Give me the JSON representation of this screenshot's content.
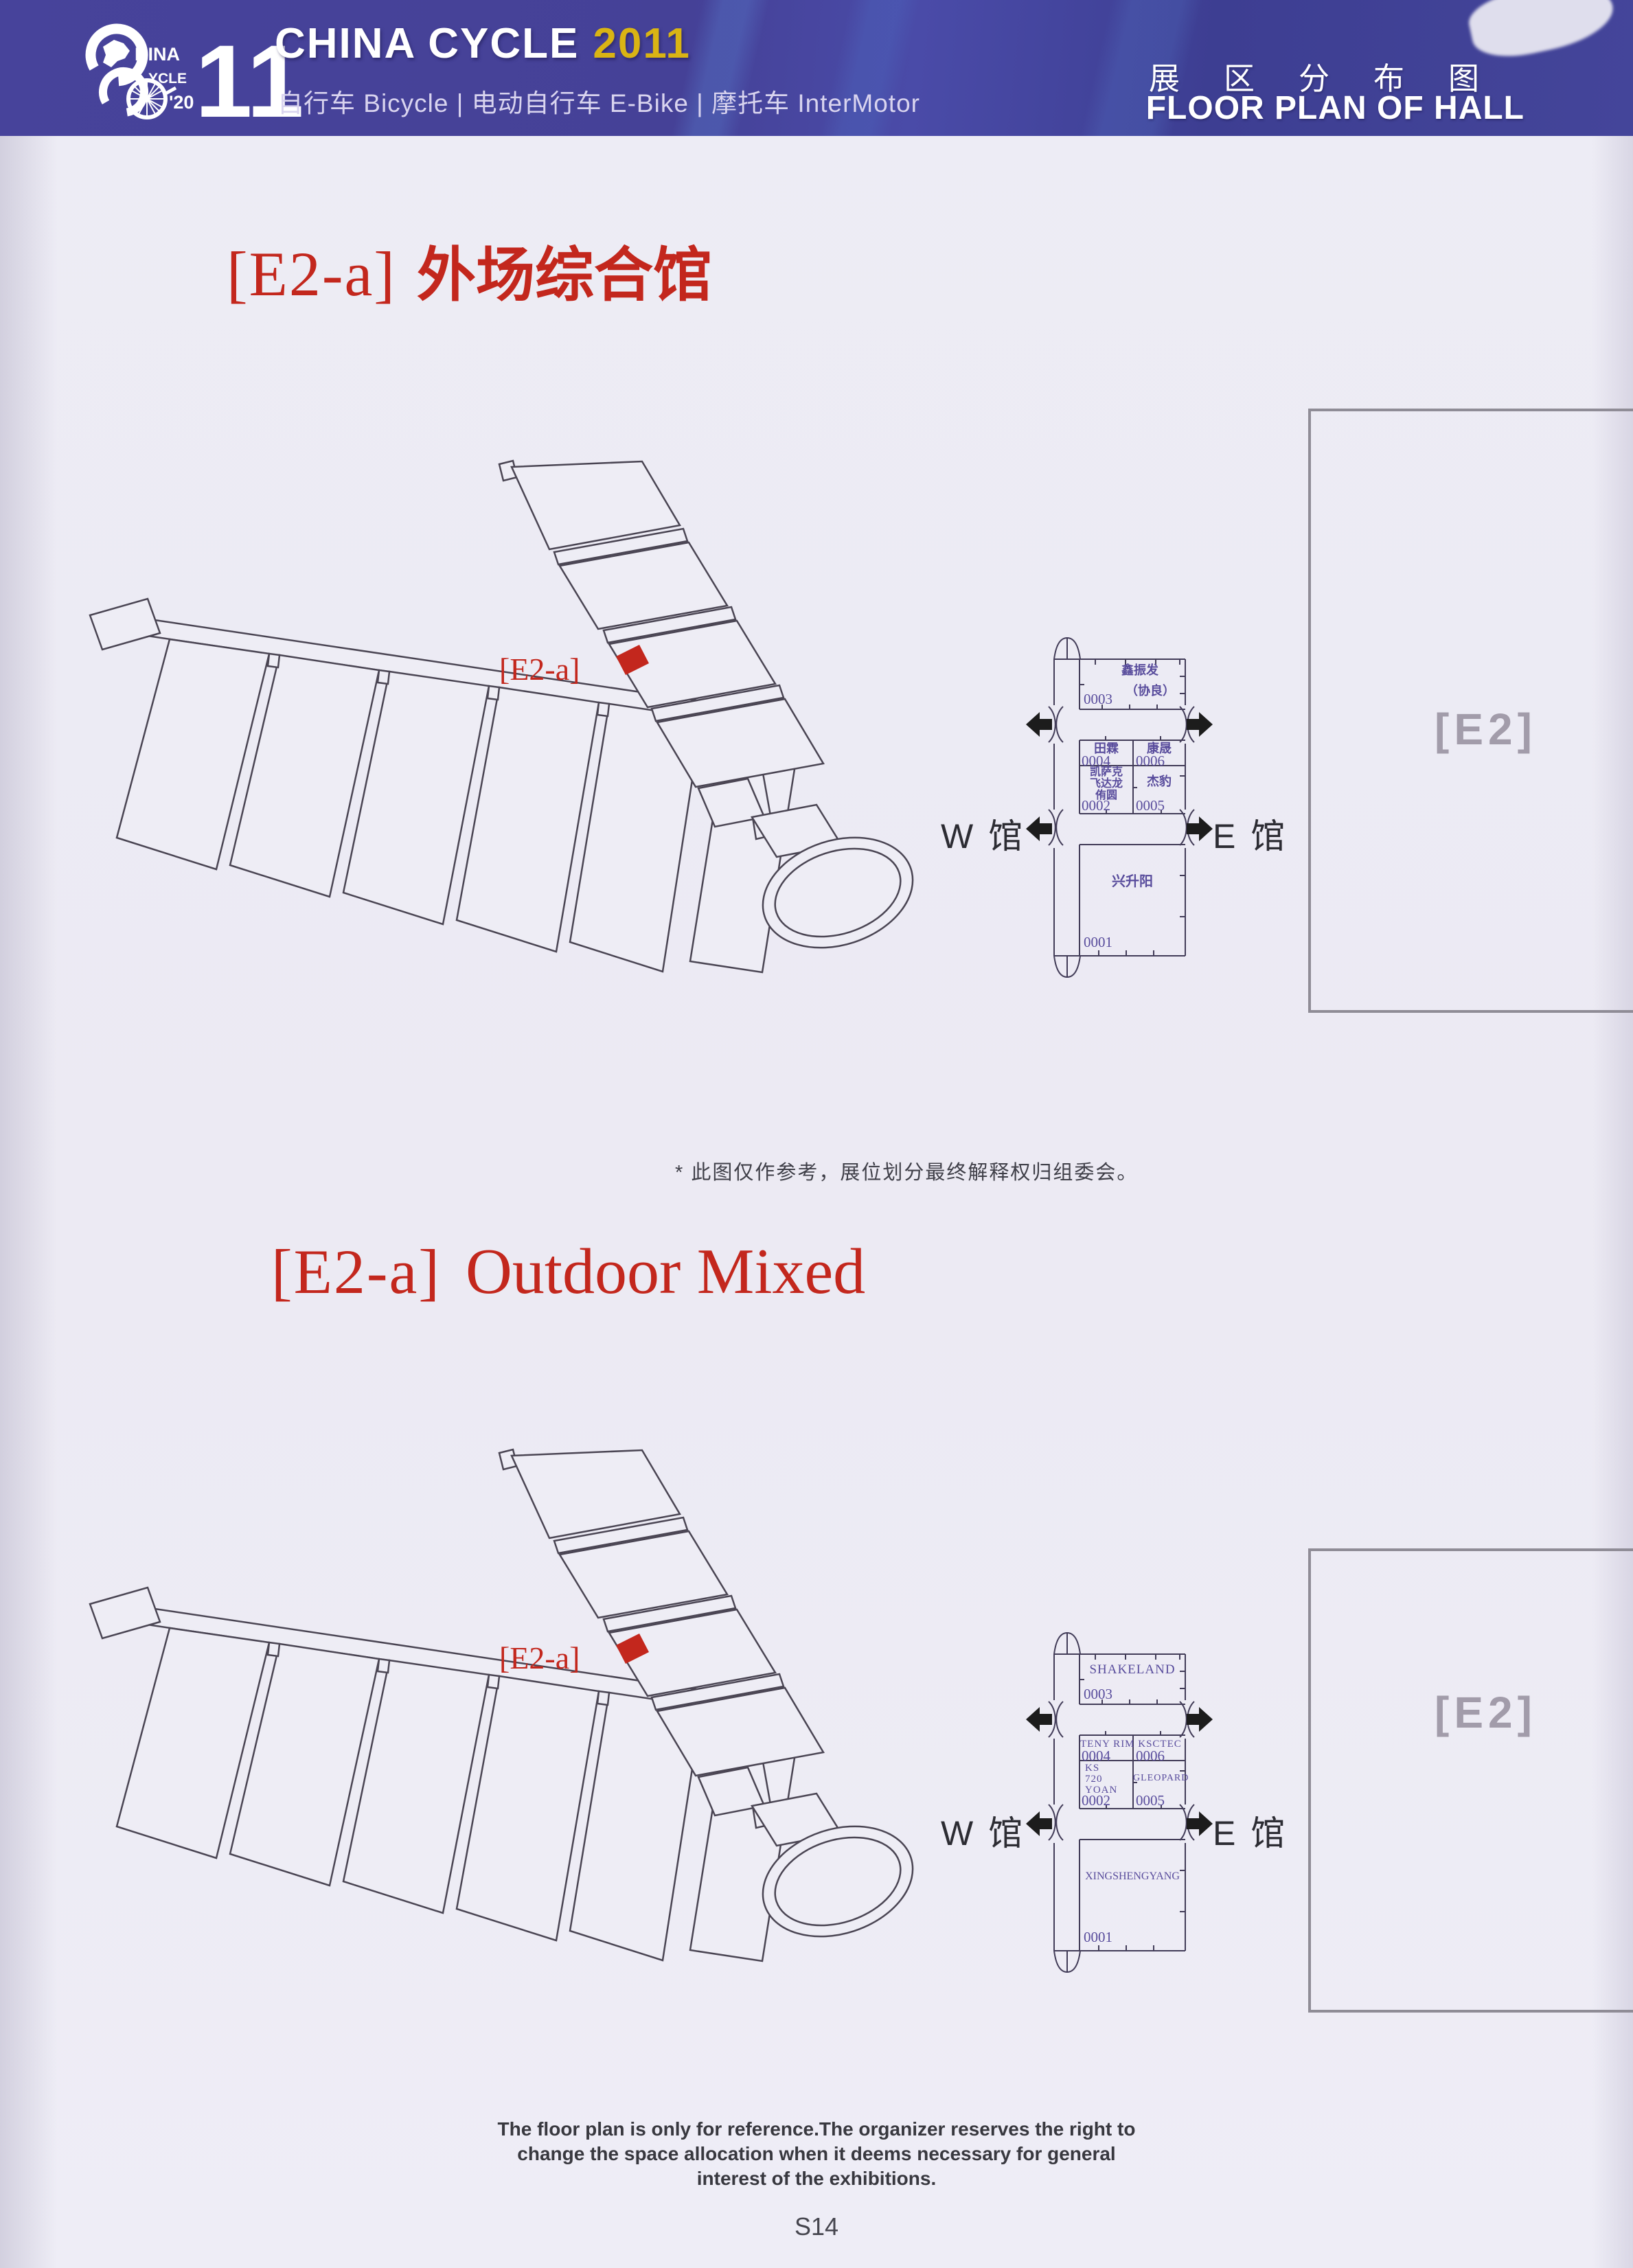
{
  "header": {
    "logo": {
      "hina": "HINA",
      "ycle": "YCLE",
      "year_short": "'20",
      "eleven": "11"
    },
    "brand": "CHINA CYCLE",
    "brand_year": "2011",
    "subtitle": "自行车 Bicycle | 电动自行车 E-Bike | 摩托车 InterMotor",
    "title_cn": "展区分布图",
    "title_en": "FLOOR PLAN OF HALL"
  },
  "colors": {
    "accent_red": "#c3271d",
    "brand_yellow": "#d9b414",
    "header_bg": "#47439b",
    "map_text": "#584c9c"
  },
  "section1": {
    "code": "[E2-a]",
    "title": "外场综合馆",
    "note": "* 此图仅作参考，展位划分最终解释权归组委会。"
  },
  "section2": {
    "code": "[E2-a]",
    "title": "Outdoor Mixed"
  },
  "diagram": {
    "marker_label": "[E2-a]"
  },
  "halls": {
    "west": "W 馆",
    "east": "E 馆",
    "e2": "[E2]"
  },
  "minimap1": {
    "booth_0003": {
      "num": "0003",
      "line1": "鑫振发",
      "line2": "（协良）"
    },
    "booth_0004": {
      "num": "0004",
      "name": "田霖"
    },
    "booth_0006": {
      "num": "0006",
      "name": "康晟"
    },
    "booth_0002": {
      "num": "0002",
      "line1": "凯萨克",
      "line2": "飞达龙",
      "line3": "侑圆"
    },
    "booth_0005": {
      "num": "0005",
      "name": "杰豹"
    },
    "booth_0001": {
      "num": "0001",
      "name": "兴升阳"
    }
  },
  "minimap2": {
    "booth_0003": {
      "num": "0003",
      "name": "SHAKELAND"
    },
    "booth_0004": {
      "num": "0004",
      "name": "TENY RIM"
    },
    "booth_0006": {
      "num": "0006",
      "name": "KSCTEC"
    },
    "booth_0002": {
      "num": "0002",
      "line1": "KS",
      "line2": "720",
      "line3": "YOAN"
    },
    "booth_0005": {
      "num": "0005",
      "name": "GLEOPARD"
    },
    "booth_0001": {
      "num": "0001",
      "name": "XINGSHENGYANG"
    }
  },
  "footer": {
    "line1": "The floor plan is only for reference.The organizer reserves the right to",
    "line2": "change the space allocation when it deems necessary for general",
    "line3": "interest of the exhibitions.",
    "page": "S14"
  }
}
